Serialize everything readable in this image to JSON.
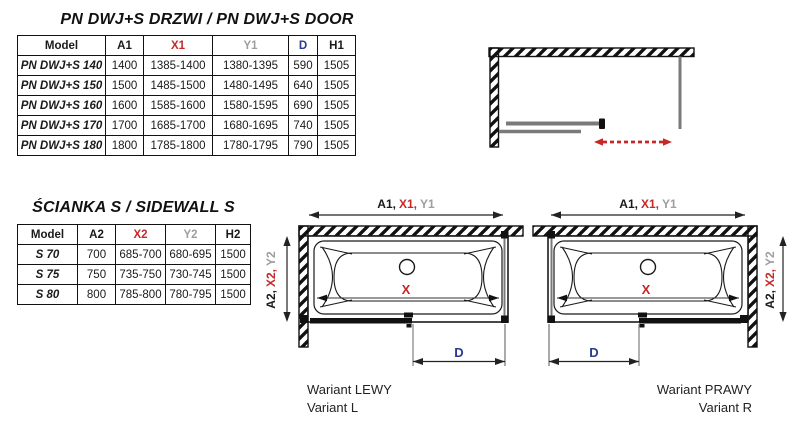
{
  "door_table": {
    "title": "PN DWJ+S DRZWI / PN DWJ+S DOOR",
    "columns": [
      "Model",
      "A1",
      "X1",
      "Y1",
      "D",
      "H1"
    ],
    "rows": [
      [
        "PN DWJ+S 140",
        "1400",
        "1385-1400",
        "1380-1395",
        "590",
        "1505"
      ],
      [
        "PN DWJ+S 150",
        "1500",
        "1485-1500",
        "1480-1495",
        "640",
        "1505"
      ],
      [
        "PN DWJ+S 160",
        "1600",
        "1585-1600",
        "1580-1595",
        "690",
        "1505"
      ],
      [
        "PN DWJ+S 170",
        "1700",
        "1685-1700",
        "1680-1695",
        "740",
        "1505"
      ],
      [
        "PN DWJ+S 180",
        "1800",
        "1785-1800",
        "1780-1795",
        "790",
        "1505"
      ]
    ]
  },
  "sidewall_table": {
    "title": "ŚCIANKA S / SIDEWALL S",
    "columns": [
      "Model",
      "A2",
      "X2",
      "Y2",
      "H2"
    ],
    "rows": [
      [
        "S 70",
        "700",
        "685-700",
        "680-695",
        "1500"
      ],
      [
        "S 75",
        "750",
        "735-750",
        "730-745",
        "1500"
      ],
      [
        "S 80",
        "800",
        "785-800",
        "780-795",
        "1500"
      ]
    ]
  },
  "diagrams": {
    "width_label": {
      "a1": "A1,",
      "x1": "X1,",
      "y1": "Y1"
    },
    "height_label": {
      "a2": "A2,",
      "x2": "X2,",
      "y2": "Y2"
    },
    "x_label": "X",
    "d_label": "D",
    "left_variant": {
      "line1": "Wariant LEWY",
      "line2": "Variant L"
    },
    "right_variant": {
      "line1": "Wariant PRAWY",
      "line2": "Variant R"
    }
  },
  "colors": {
    "dimension_red": "#c62828",
    "dimension_blue": "#2a3b8f",
    "dimension_grey": "#9e9e9e",
    "line_black": "#1a1a1a",
    "glass_grey": "#7a7a7a"
  }
}
